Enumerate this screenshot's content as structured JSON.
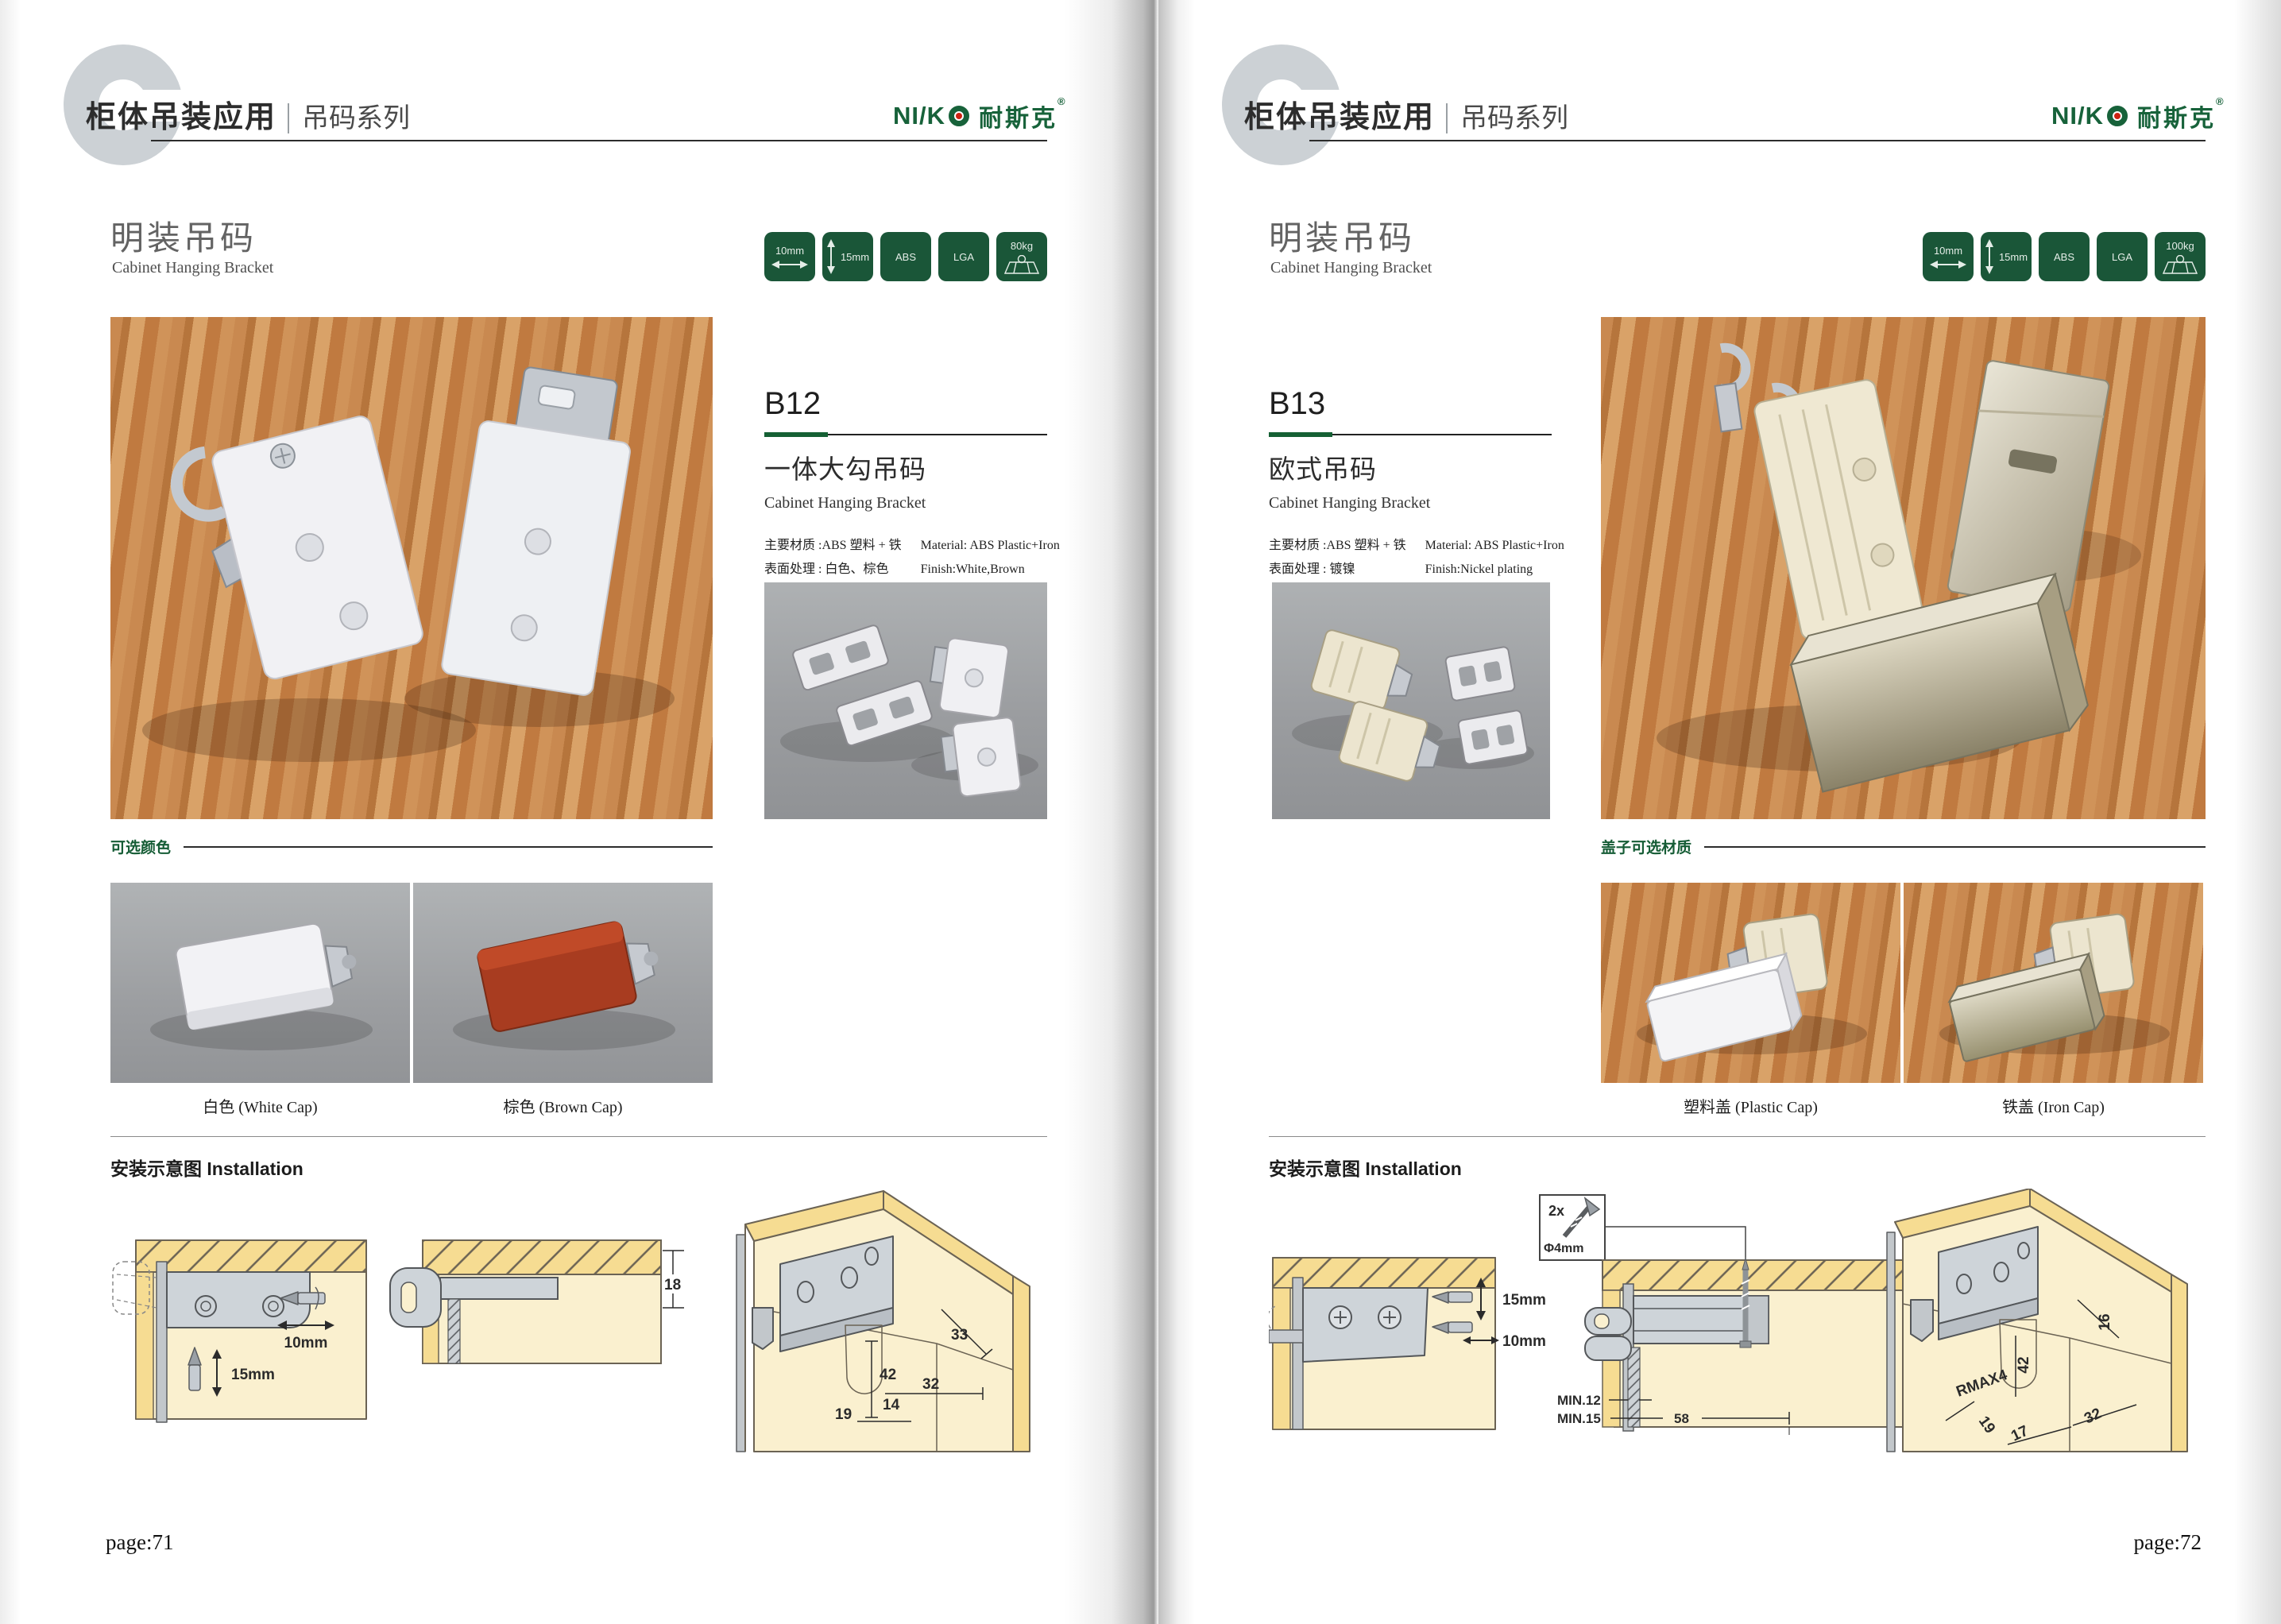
{
  "theme": {
    "brand_green": "#17623a",
    "badge_green": "#1a5638",
    "accent_green": "#156034",
    "diagram_wood": "#f6dc92",
    "diagram_cream": "#faf0cf"
  },
  "left": {
    "header": {
      "watermark": "C",
      "title": "柜体吊装应用",
      "series": "吊码系列"
    },
    "logo": {
      "latin": "NI/K",
      "cn": "耐斯克",
      "reg": "®"
    },
    "section": {
      "title_cn": "明装吊码",
      "title_en": "Cabinet Hanging Bracket"
    },
    "badges": [
      {
        "label": "10mm"
      },
      {
        "label": "15mm"
      },
      {
        "label": "ABS"
      },
      {
        "label": "LGA"
      },
      {
        "label": "80kg"
      }
    ],
    "product": {
      "code": "B12",
      "name_cn": "一体大勾吊码",
      "name_en": "Cabinet Hanging Bracket",
      "material_cn": "主要材质 :ABS 塑料 + 铁",
      "finish_cn": "表面处理 : 白色、棕色",
      "material_en": "Material: ABS Plastic+Iron",
      "finish_en": "Finish:White,Brown"
    },
    "options": {
      "label": "可选颜色",
      "caption1": "白色 (White Cap)",
      "caption2": "棕色 (Brown Cap)"
    },
    "install": {
      "title": "安装示意图 Installation",
      "width": "10mm",
      "height": "15mm",
      "thickness": "18",
      "a33": "33",
      "a42": "42",
      "a32": "32",
      "a19": "19",
      "a14": "14"
    },
    "page_number": "page:71"
  },
  "right": {
    "header": {
      "watermark": "C",
      "title": "柜体吊装应用",
      "series": "吊码系列"
    },
    "logo": {
      "latin": "NI/K",
      "cn": "耐斯克",
      "reg": "®"
    },
    "section": {
      "title_cn": "明装吊码",
      "title_en": "Cabinet Hanging Bracket"
    },
    "badges": [
      {
        "label": "10mm"
      },
      {
        "label": "15mm"
      },
      {
        "label": "ABS"
      },
      {
        "label": "LGA"
      },
      {
        "label": "100kg"
      }
    ],
    "product": {
      "code": "B13",
      "name_cn": "欧式吊码",
      "name_en": "Cabinet Hanging Bracket",
      "material_cn": "主要材质 :ABS 塑料 + 铁",
      "finish_cn": "表面处理 : 镀镍",
      "material_en": "Material: ABS Plastic+Iron",
      "finish_en": "Finish:Nickel plating"
    },
    "options": {
      "label": "盖子可选材质",
      "caption1": "塑料盖 (Plastic Cap)",
      "caption2": "铁盖 (Iron Cap)"
    },
    "install": {
      "title": "安装示意图 Installation",
      "screw_qty": "2x",
      "screw_dia": "Φ4mm",
      "height": "15mm",
      "width": "10mm",
      "thickness": "18",
      "min1": "MIN.12",
      "min2": "MIN.15",
      "w58": "58",
      "a16": "16",
      "a42": "42",
      "rmax": "RMAX4",
      "a19": "19",
      "a32": "32",
      "a17": "17"
    },
    "page_number": "page:72"
  }
}
